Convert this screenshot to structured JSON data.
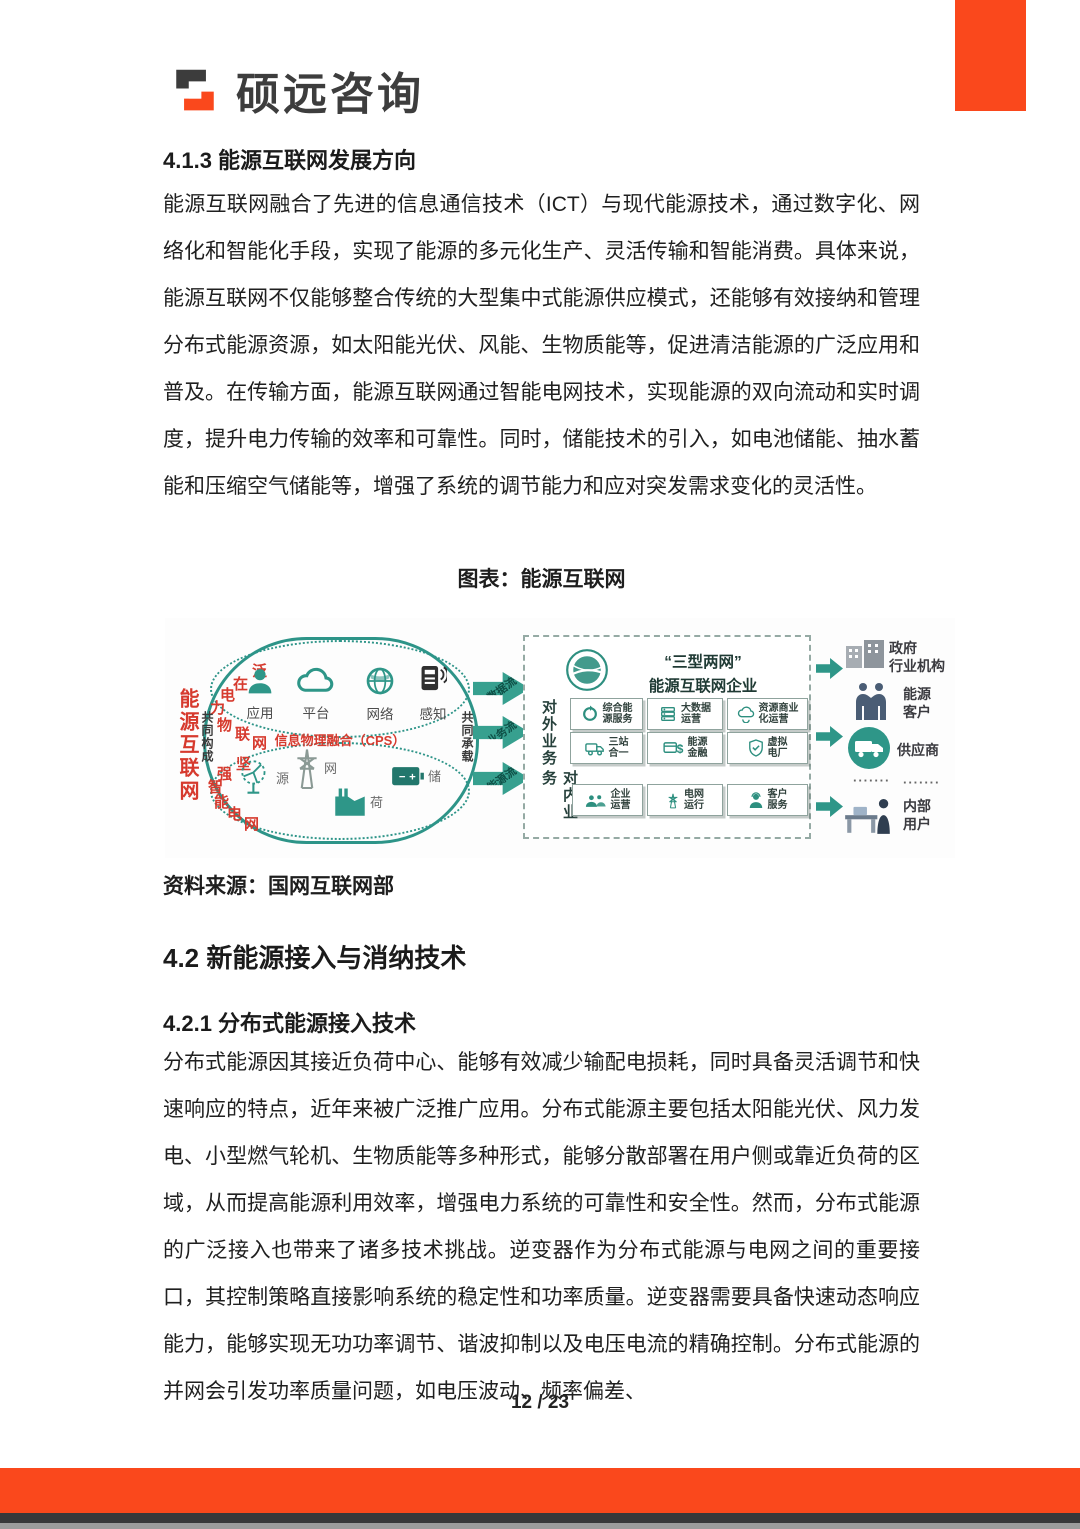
{
  "brand": {
    "name": "硕远咨询"
  },
  "headings": {
    "h413": "4.1.3 能源互联网发展方向",
    "h42": "4.2 新能源接入与消纳技术",
    "h421": "4.2.1 分布式能源接入技术"
  },
  "paragraphs": {
    "p1": "能源互联网融合了先进的信息通信技术（ICT）与现代能源技术，通过数字化、网络化和智能化手段，实现了能源的多元化生产、灵活传输和智能消费。具体来说，能源互联网不仅能够整合传统的大型集中式能源供应模式，还能够有效接纳和管理分布式能源资源，如太阳能光伏、风能、生物质能等，促进清洁能源的广泛应用和普及。在传输方面，能源互联网通过智能电网技术，实现能源的双向流动和实时调度，提升电力传输的效率和可靠性。同时，储能技术的引入，如电池储能、抽水蓄能和压缩空气储能等，增强了系统的调节能力和应对突发需求变化的灵活性。",
    "p2": "分布式能源因其接近负荷中心、能够有效减少输配电损耗，同时具备灵活调节和快速响应的特点，近年来被广泛推广应用。分布式能源主要包括太阳能光伏、风力发电、小型燃气轮机、生物质能等多种形式，能够分散部署在用户侧或靠近负荷的区域，从而提高能源利用效率，增强电力系统的可靠性和安全性。然而，分布式能源的广泛接入也带来了诸多技术挑战。逆变器作为分布式能源与电网之间的重要接口，其控制策略直接影响系统的稳定性和功率质量。逆变器需要具备快速动态响应能力，能够实现无功功率调节、谐波抑制以及电压电流的精确控制。分布式能源的并网会引发功率质量问题，如电压波动、频率偏差、"
  },
  "figure": {
    "caption": "图表：能源互联网",
    "source": "资料来源：国网互联网部"
  },
  "footer": {
    "page_number": "12 / 23"
  },
  "colors": {
    "accent_orange": "#fa481c",
    "diagram_teal": "#2d9488",
    "diagram_red": "#d63a2e"
  },
  "diagram": {
    "left_title": "能源互联网",
    "iot_chars": [
      "泛",
      "在",
      "电",
      "力",
      "物",
      "联",
      "网"
    ],
    "grid_chars": [
      "坚",
      "强",
      "智",
      "能",
      "电",
      "网"
    ],
    "compose_label": "共同构成",
    "carry_label": "共同承载",
    "cps_label": "信息物理融合（CPS）",
    "top_nodes": [
      "应用",
      "平台",
      "网络",
      "感知"
    ],
    "bottom_nodes": [
      "源",
      "网",
      "荷",
      "储"
    ],
    "flows": [
      "数据流",
      "业务流",
      "能源流"
    ],
    "center": {
      "title_quote": "“三型两网”",
      "title_main": "能源互联网企业",
      "external_label": "对外业务",
      "internal_label": "对内业务",
      "cells": [
        "综合能\n源服务",
        "大数据\n运营",
        "资源商业\n化运营",
        "三站\n合一",
        "能源\n金融",
        "虚拟\n电厂",
        "企业\n运营",
        "电网\n运行",
        "客户\n服务"
      ]
    },
    "right": {
      "items": [
        "政府\n行业机构",
        "能源\n客户",
        "供应商",
        "内部\n用户"
      ],
      "dots_left": "·······",
      "dots_right": "·······"
    }
  }
}
